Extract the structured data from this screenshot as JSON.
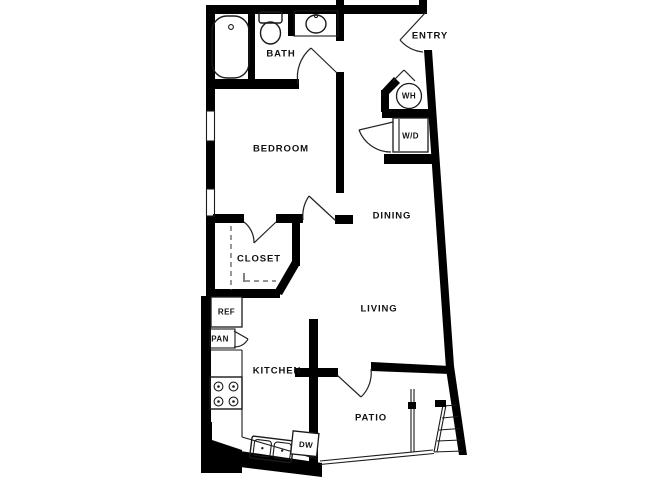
{
  "plan": {
    "title": "One-bedroom apartment floor plan",
    "colors": {
      "background": "#ffffff",
      "wall": "#000000",
      "thin_line": "#1a1a1a",
      "label_text": "#111111"
    },
    "rooms": {
      "bath": "BATH",
      "entry": "ENTRY",
      "bedroom": "BEDROOM",
      "dining": "DINING",
      "closet": "CLOSET",
      "living": "LIVING",
      "kitchen": "KITCHEN",
      "patio": "PATIO"
    },
    "fixtures": {
      "water_heater": "WH",
      "washer_dryer": "W/D",
      "refrigerator": "REF",
      "pantry": "PAN",
      "dishwasher": "DW"
    },
    "icons": [
      "bathtub-icon",
      "toilet-icon",
      "sink-icon",
      "stove-burners-icon",
      "double-kitchen-sink-icon",
      "stairs-icon",
      "door-swing-icon",
      "window-icon"
    ]
  }
}
